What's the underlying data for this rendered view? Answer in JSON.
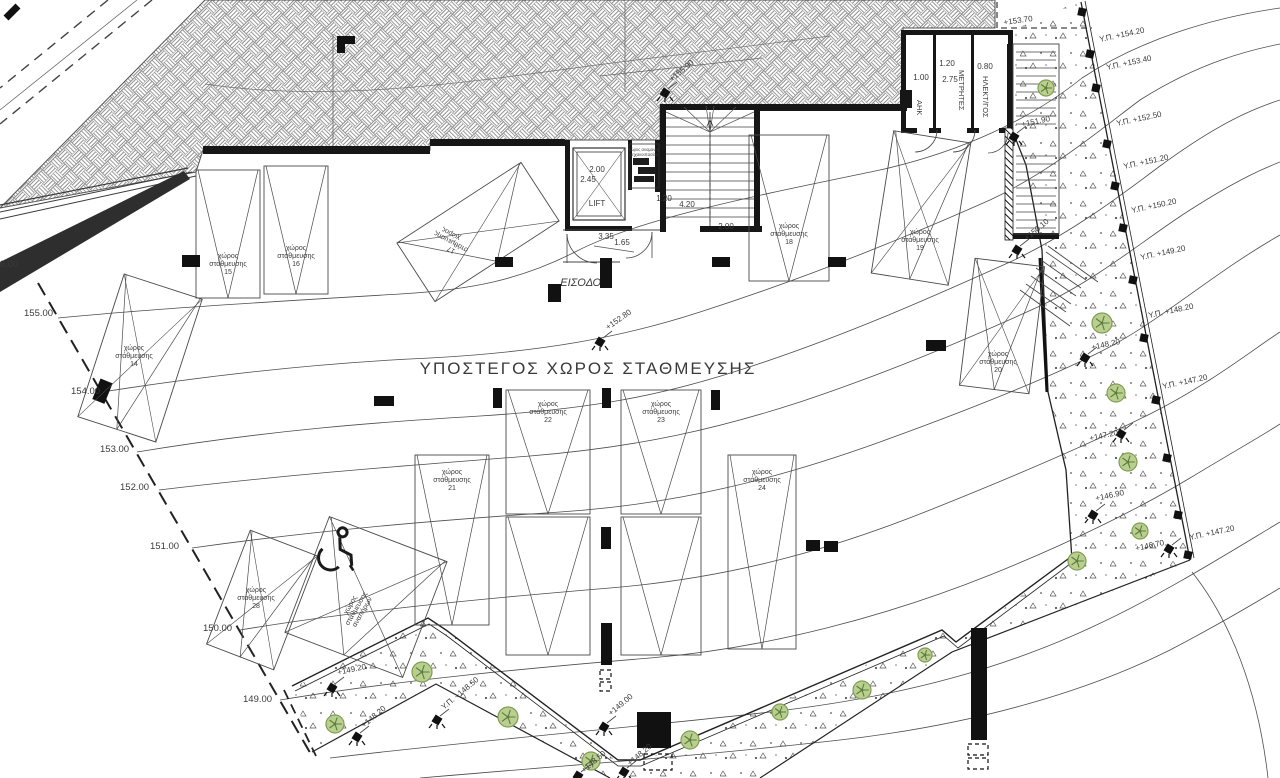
{
  "drawing": {
    "title": "ΥΠΟΣΤΕΓΟΣ ΧΩΡΟΣ ΣΤΑΘΜΕΥΣΗΣ",
    "entrance_label": "ΕΙΣΟΔΟΣ",
    "lift_label": "LIFT"
  },
  "labels": {
    "parking_word": [
      "χώρος",
      "στάθμευσης"
    ],
    "disabled_space": [
      "χώρος",
      "στάθμευσης",
      "αναπήρων"
    ],
    "machine_room": [
      "χώρος αναμονής",
      "μηχανοστασίου"
    ]
  },
  "rooms": [
    {
      "name": "ΑΗΚ",
      "x": 917,
      "y": 100
    },
    {
      "name": "ΜΕΤΡΗΤΕΣ",
      "x": 959,
      "y": 70
    },
    {
      "name": "ΗΛΕΚΤ/ΓΟΣ",
      "x": 983,
      "y": 76
    }
  ],
  "dimensions": [
    {
      "t": "2.00",
      "x": 597,
      "y": 172
    },
    {
      "t": "2.45",
      "x": 588,
      "y": 182
    },
    {
      "t": "1.20",
      "x": 664,
      "y": 201
    },
    {
      "t": "4.20",
      "x": 687,
      "y": 207
    },
    {
      "t": "2.00",
      "x": 726,
      "y": 229
    },
    {
      "t": "3.35",
      "x": 606,
      "y": 239
    },
    {
      "t": "1.65",
      "x": 622,
      "y": 245
    },
    {
      "t": "1.00",
      "x": 921,
      "y": 80
    },
    {
      "t": "1.20",
      "x": 947,
      "y": 66
    },
    {
      "t": "2.75",
      "x": 950,
      "y": 82
    },
    {
      "t": "0.80",
      "x": 985,
      "y": 69
    }
  ],
  "parking_spaces": [
    {
      "no": "14",
      "cx": 140,
      "cy": 358,
      "w": 82,
      "h": 150,
      "rot": 18,
      "lx": 134,
      "ly": 350,
      "lrot": 0
    },
    {
      "no": "15",
      "cx": 228,
      "cy": 234,
      "w": 64,
      "h": 128,
      "rot": 0,
      "lx": 228,
      "ly": 258,
      "lrot": 0
    },
    {
      "no": "16",
      "cx": 296,
      "cy": 230,
      "w": 64,
      "h": 128,
      "rot": 0,
      "lx": 296,
      "ly": 250,
      "lrot": 0
    },
    {
      "no": "17",
      "cx": 478,
      "cy": 232,
      "w": 148,
      "h": 70,
      "rot": -33,
      "lx": 452,
      "ly": 232,
      "lrot": 208
    },
    {
      "no": "18",
      "cx": 789,
      "cy": 208,
      "w": 80,
      "h": 146,
      "rot": 0,
      "lx": 789,
      "ly": 228,
      "lrot": 0
    },
    {
      "no": "19",
      "cx": 921,
      "cy": 208,
      "w": 78,
      "h": 144,
      "rot": 9,
      "lx": 920,
      "ly": 234,
      "lrot": 0
    },
    {
      "no": "20",
      "cx": 1002,
      "cy": 326,
      "w": 70,
      "h": 128,
      "rot": 7,
      "lx": 998,
      "ly": 356,
      "lrot": 0
    },
    {
      "no": "21",
      "cx": 452,
      "cy": 540,
      "w": 74,
      "h": 170,
      "rot": 0,
      "lx": 452,
      "ly": 474,
      "lrot": 0
    },
    {
      "no": "22",
      "cx": 548,
      "cy": 452,
      "w": 84,
      "h": 124,
      "rot": 0,
      "lx": 548,
      "ly": 406,
      "lrot": 0
    },
    {
      "no": "",
      "cx": 548,
      "cy": 586,
      "w": 84,
      "h": 138,
      "rot": 0,
      "lx": 0,
      "ly": 0,
      "lrot": 0
    },
    {
      "no": "23",
      "cx": 661,
      "cy": 452,
      "w": 80,
      "h": 124,
      "rot": 0,
      "lx": 661,
      "ly": 406,
      "lrot": 0
    },
    {
      "no": "",
      "cx": 661,
      "cy": 586,
      "w": 80,
      "h": 138,
      "rot": 0,
      "lx": 0,
      "ly": 0,
      "lrot": 0
    },
    {
      "no": "24",
      "cx": 762,
      "cy": 552,
      "w": 68,
      "h": 194,
      "rot": 0,
      "lx": 762,
      "ly": 474,
      "lrot": 0
    },
    {
      "no": "28",
      "cx": 262,
      "cy": 600,
      "w": 72,
      "h": 122,
      "rot": 21,
      "lx": 256,
      "ly": 592,
      "lrot": 0
    }
  ],
  "disabled_space": {
    "cx": 366,
    "cy": 597,
    "w": 126,
    "h": 124,
    "rot": 21,
    "label_x": 352,
    "label_y": 606,
    "label_rot": -60,
    "icon_x": 332,
    "icon_y": 552,
    "icon_rot": 18
  },
  "spot_levels": [
    {
      "t": "+155.90",
      "sx": 665,
      "sy": 93,
      "lx": 672,
      "ly": 82,
      "lr": -40
    },
    {
      "t": "+152.80",
      "sx": 600,
      "sy": 342,
      "lx": 608,
      "ly": 330,
      "lr": -35
    },
    {
      "t": "+151.90",
      "sx": 1014,
      "sy": 137,
      "lx": 1022,
      "ly": 127,
      "lr": -12
    },
    {
      "t": "+150.10",
      "sx": 1017,
      "sy": 250,
      "lx": 1027,
      "ly": 241,
      "lr": -40
    },
    {
      "t": "+148.20",
      "sx": 1085,
      "sy": 358,
      "lx": 1092,
      "ly": 350,
      "lr": -12
    },
    {
      "t": "+147.20",
      "sx": 1121,
      "sy": 434,
      "lx": 1090,
      "ly": 441,
      "lr": -12
    },
    {
      "t": "+146.90",
      "sx": 1093,
      "sy": 515,
      "lx": 1096,
      "ly": 501,
      "lr": -12
    },
    {
      "t": "+146.70",
      "sx": 1169,
      "sy": 549,
      "lx": 1136,
      "ly": 551,
      "lr": -12
    },
    {
      "t": "+149.20",
      "sx": 332,
      "sy": 688,
      "lx": 338,
      "ly": 675,
      "lr": -12
    },
    {
      "t": "+148.20",
      "sx": 357,
      "sy": 737,
      "lx": 364,
      "ly": 728,
      "lr": -40
    },
    {
      "t": "Υ.Π. +148.50",
      "sx": 437,
      "sy": 720,
      "lx": 444,
      "ly": 710,
      "lr": -40
    },
    {
      "t": "+149.00",
      "sx": 604,
      "sy": 727,
      "lx": 611,
      "ly": 716,
      "lr": -40
    },
    {
      "t": "+148.50",
      "sx": 578,
      "sy": 776,
      "lx": 584,
      "ly": 773,
      "lr": -40
    },
    {
      "t": "+148.20",
      "sx": 624,
      "sy": 772,
      "lx": 630,
      "ly": 766,
      "lr": -40
    }
  ],
  "edge_levels": [
    {
      "t": "Υ.Π. +154.20",
      "x": 1100,
      "y": 42,
      "rot": -12
    },
    {
      "t": "Υ.Π. +153.40",
      "x": 1107,
      "y": 70,
      "rot": -12
    },
    {
      "t": "Υ.Π. +152.50",
      "x": 1117,
      "y": 126,
      "rot": -12
    },
    {
      "t": "Υ.Π. +151.20",
      "x": 1124,
      "y": 169,
      "rot": -12
    },
    {
      "t": "Υ.Π. +150.20",
      "x": 1132,
      "y": 213,
      "rot": -12
    },
    {
      "t": "Υ.Π. +149.20",
      "x": 1141,
      "y": 260,
      "rot": -12
    },
    {
      "t": "Υ.Π. +148.20",
      "x": 1149,
      "y": 318,
      "rot": -12
    },
    {
      "t": "Υ.Π. +147.20",
      "x": 1163,
      "y": 389,
      "rot": -12
    },
    {
      "t": "Υ.Π. +147.20",
      "x": 1190,
      "y": 540,
      "rot": -12
    },
    {
      "t": "+153.70",
      "x": 1004,
      "y": 25,
      "rot": -8
    }
  ],
  "contour_labels": [
    {
      "t": "156.00",
      "x": -11,
      "y": 267
    },
    {
      "t": "155.00",
      "x": 24,
      "y": 316
    },
    {
      "t": "154.00",
      "x": 71,
      "y": 394
    },
    {
      "t": "153.00",
      "x": 100,
      "y": 452
    },
    {
      "t": "152.00",
      "x": 120,
      "y": 490
    },
    {
      "t": "151.00",
      "x": 150,
      "y": 549
    },
    {
      "t": "150.00",
      "x": 203,
      "y": 631
    },
    {
      "t": "149.00",
      "x": 243,
      "y": 702
    }
  ],
  "trees": [
    {
      "x": 1046,
      "y": 88,
      "r": 8
    },
    {
      "x": 1102,
      "y": 323,
      "r": 10
    },
    {
      "x": 1116,
      "y": 393,
      "r": 9
    },
    {
      "x": 1128,
      "y": 462,
      "r": 9
    },
    {
      "x": 1140,
      "y": 531,
      "r": 8
    },
    {
      "x": 1077,
      "y": 561,
      "r": 9
    },
    {
      "x": 335,
      "y": 724,
      "r": 9
    },
    {
      "x": 422,
      "y": 672,
      "r": 10
    },
    {
      "x": 508,
      "y": 717,
      "r": 10
    },
    {
      "x": 591,
      "y": 761,
      "r": 9
    },
    {
      "x": 690,
      "y": 740,
      "r": 9
    },
    {
      "x": 780,
      "y": 712,
      "r": 8
    },
    {
      "x": 862,
      "y": 690,
      "r": 9
    },
    {
      "x": 925,
      "y": 655,
      "r": 7
    }
  ],
  "fence_posts": [
    {
      "x": 1082,
      "y": 12
    },
    {
      "x": 1090,
      "y": 54
    },
    {
      "x": 1096,
      "y": 88
    },
    {
      "x": 1107,
      "y": 144
    },
    {
      "x": 1115,
      "y": 186
    },
    {
      "x": 1123,
      "y": 228
    },
    {
      "x": 1133,
      "y": 280
    },
    {
      "x": 1144,
      "y": 338
    },
    {
      "x": 1156,
      "y": 400
    },
    {
      "x": 1167,
      "y": 458
    },
    {
      "x": 1178,
      "y": 515
    },
    {
      "x": 1188,
      "y": 555
    }
  ],
  "colors": {
    "line": "#3a3a3a",
    "wall": "#161616",
    "contour": "#4d4d4d",
    "tree_fill": "#b9cf92",
    "tree_stroke": "#7f9e50",
    "tree_core": "#5e7d36",
    "hatch": "#8a8a8a",
    "stipple": "#555555"
  }
}
